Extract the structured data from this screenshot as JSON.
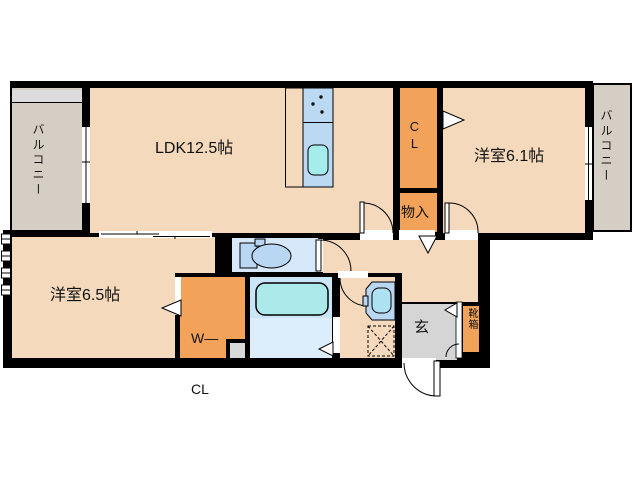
{
  "rooms": {
    "balcony_left": "バルコニー",
    "ldk": "LDK12.5帖",
    "closet": "CL",
    "bedroom_east": "洋室6.1帖",
    "balcony_right": "バルコニー",
    "storage": "物入",
    "bedroom_west": "洋室6.5帖",
    "walk_in_closet": {
      "line1": "W—",
      "line2": "CL"
    },
    "entrance": "玄",
    "shoe_cabinet": "靴箱"
  },
  "colors": {
    "wall": "#000000",
    "room_floor": "#f4d9bc",
    "closet_orange": "#f2a259",
    "balcony_floor": "#d5cec4",
    "balcony_upper_strip": "#dcdcdc",
    "entry_gray": "#d5d5d5",
    "toilet_floor": "#d7e8fa",
    "bath_floor": "#cbe5f8",
    "washing_area_floor": "#dcedfc",
    "fixture_blue": "#b9d7f2",
    "kitchen_blue": "#bcd9f4",
    "tub_cyan": "#ace9ea",
    "sink_cyan": "#a5eced",
    "pipe_space_gray": "#d9d9d9"
  }
}
